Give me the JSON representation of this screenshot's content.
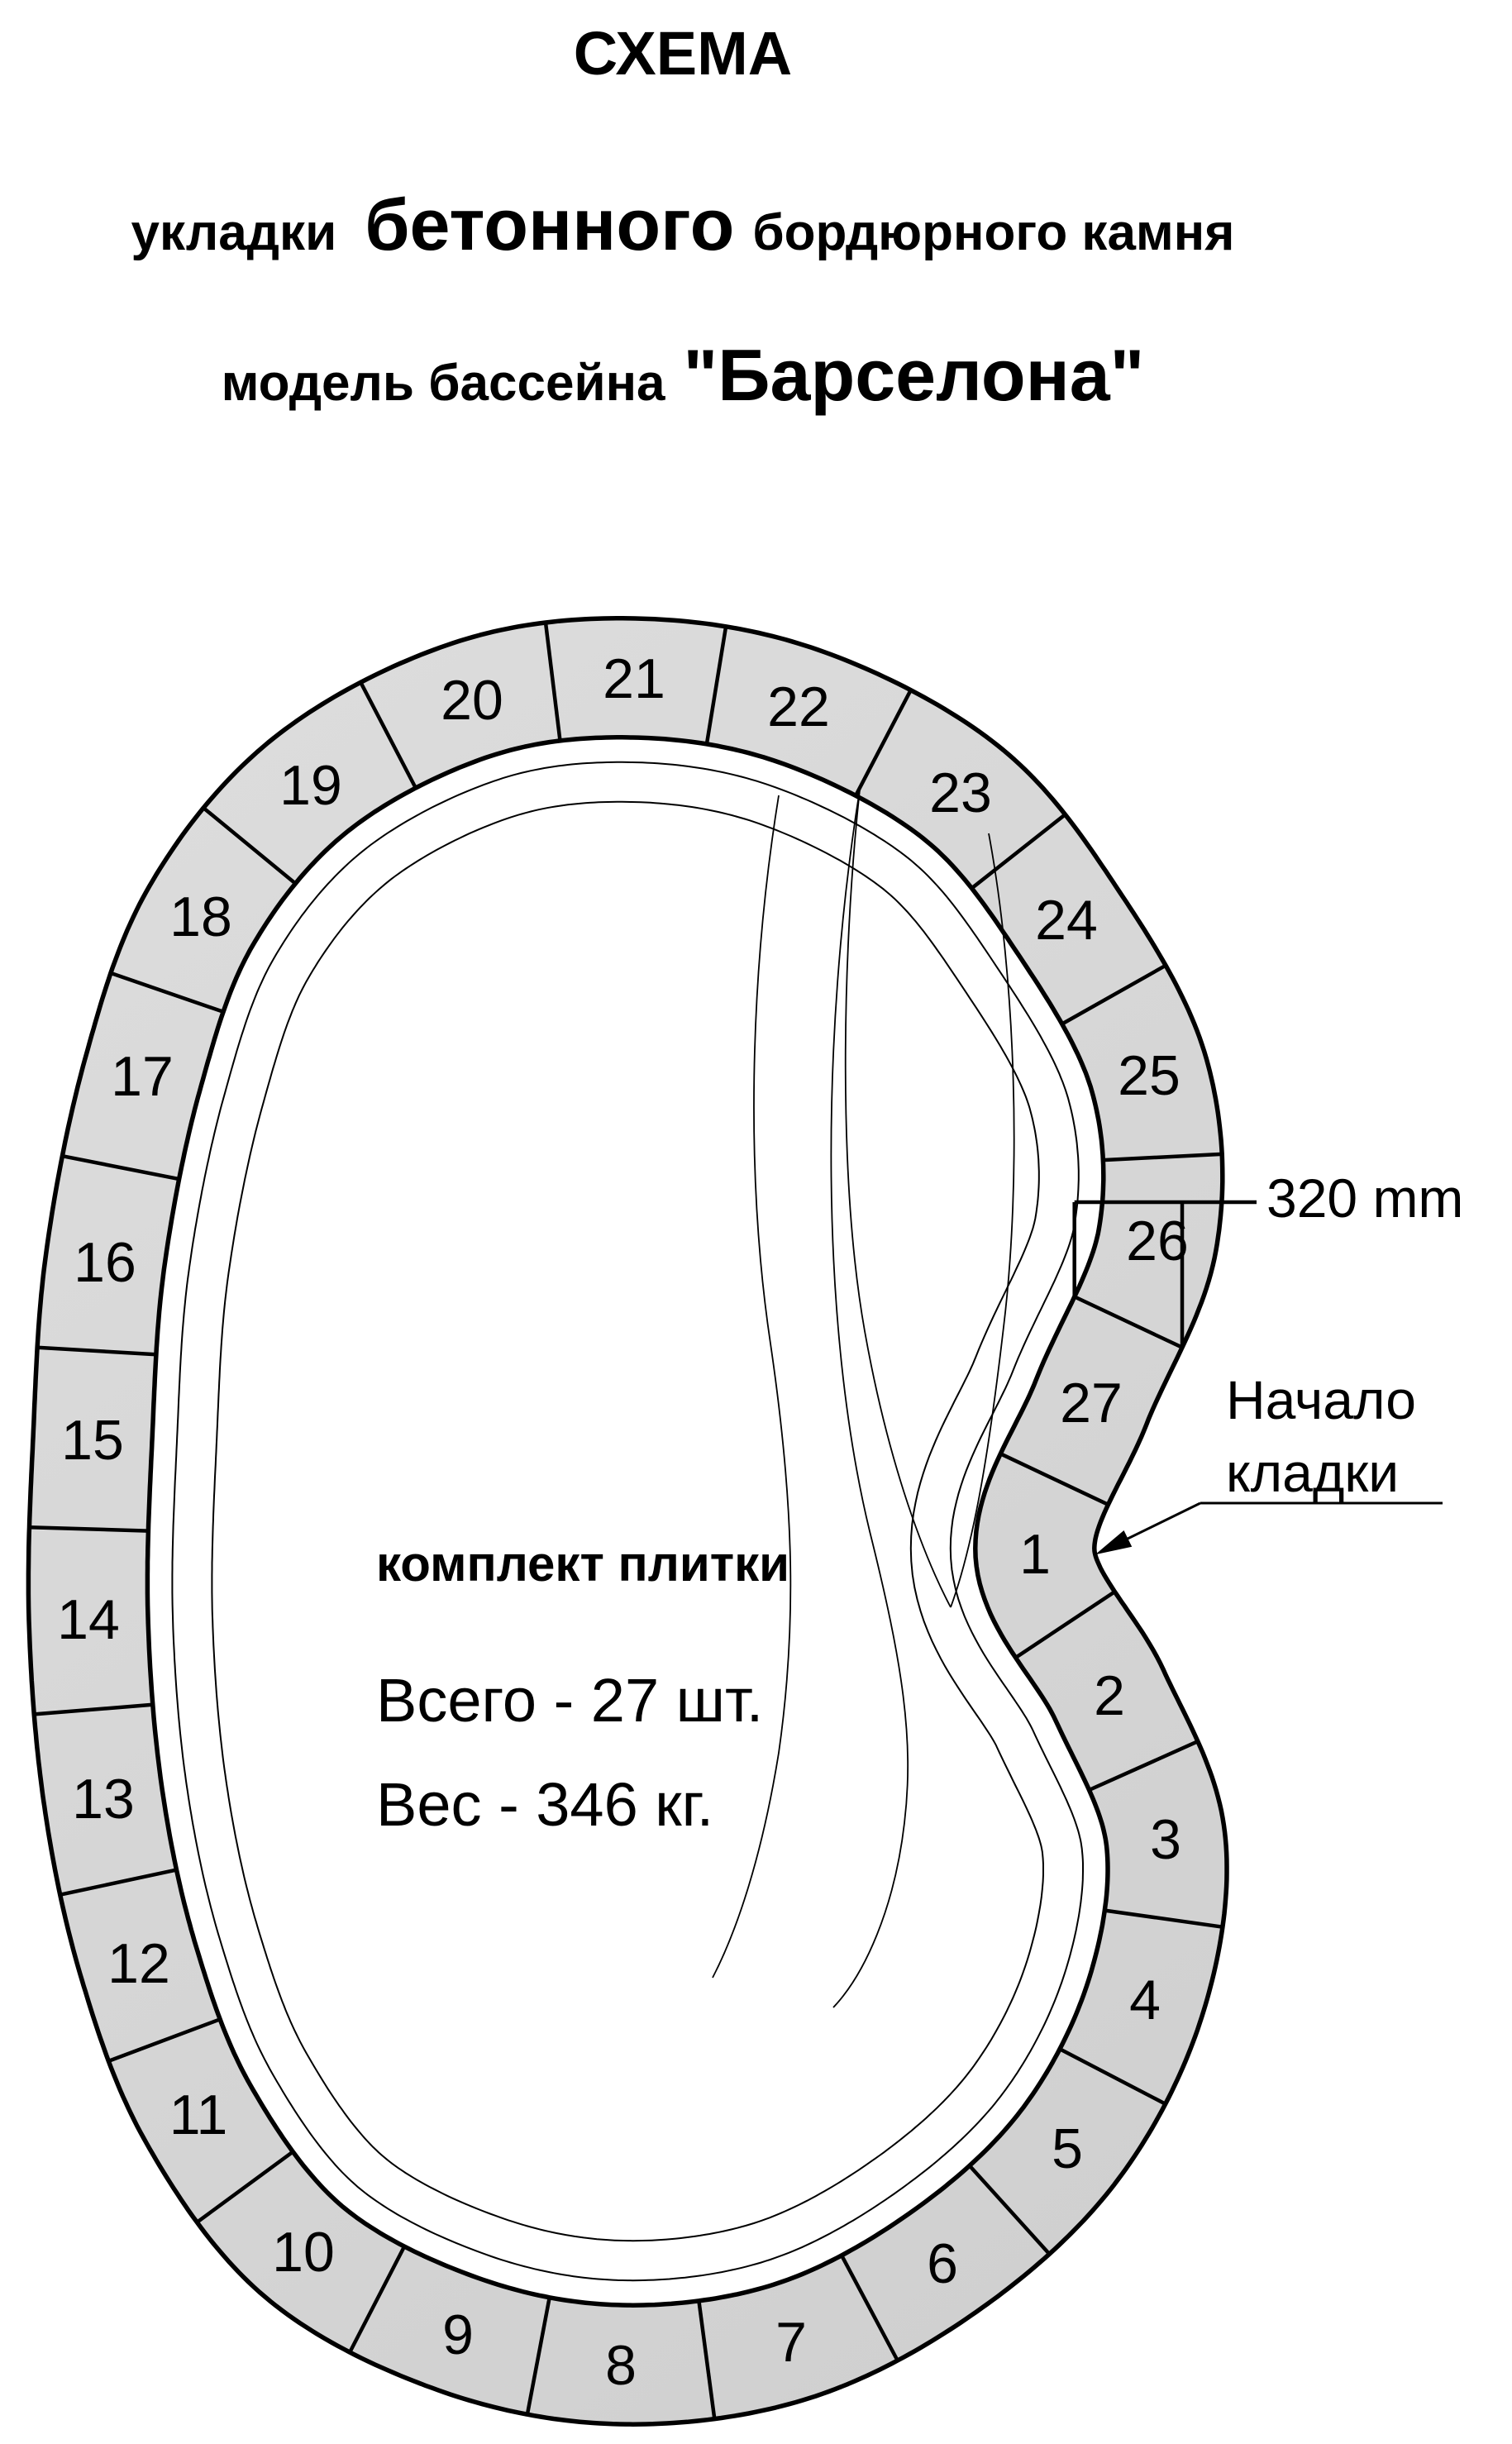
{
  "header": {
    "title": "СХЕМА",
    "subtitle_pre": "укладки",
    "subtitle_big": "бетонного",
    "subtitle_post": "бордюрного камня",
    "model_pre": "модель бассейна",
    "model_big": "\"Барселона\""
  },
  "kit": {
    "heading": "комплект плитки",
    "total": "Всего - 27 шт.",
    "weight": "Вес - 346 кг."
  },
  "dimension": {
    "label": "320 mm"
  },
  "annotation": {
    "line1": "Начало",
    "line2": "кладки"
  },
  "tiles": [
    "1",
    "2",
    "3",
    "4",
    "5",
    "6",
    "7",
    "8",
    "9",
    "10",
    "11",
    "12",
    "13",
    "14",
    "15",
    "16",
    "17",
    "18",
    "19",
    "20",
    "21",
    "22",
    "23",
    "24",
    "25",
    "26",
    "27"
  ],
  "colors": {
    "tile_fill": "#d5d5d5",
    "tile_fill_light": "#dcdcdc",
    "tile_fill_dark": "#d0d0d0",
    "line": "#000000",
    "background": "#ffffff"
  }
}
